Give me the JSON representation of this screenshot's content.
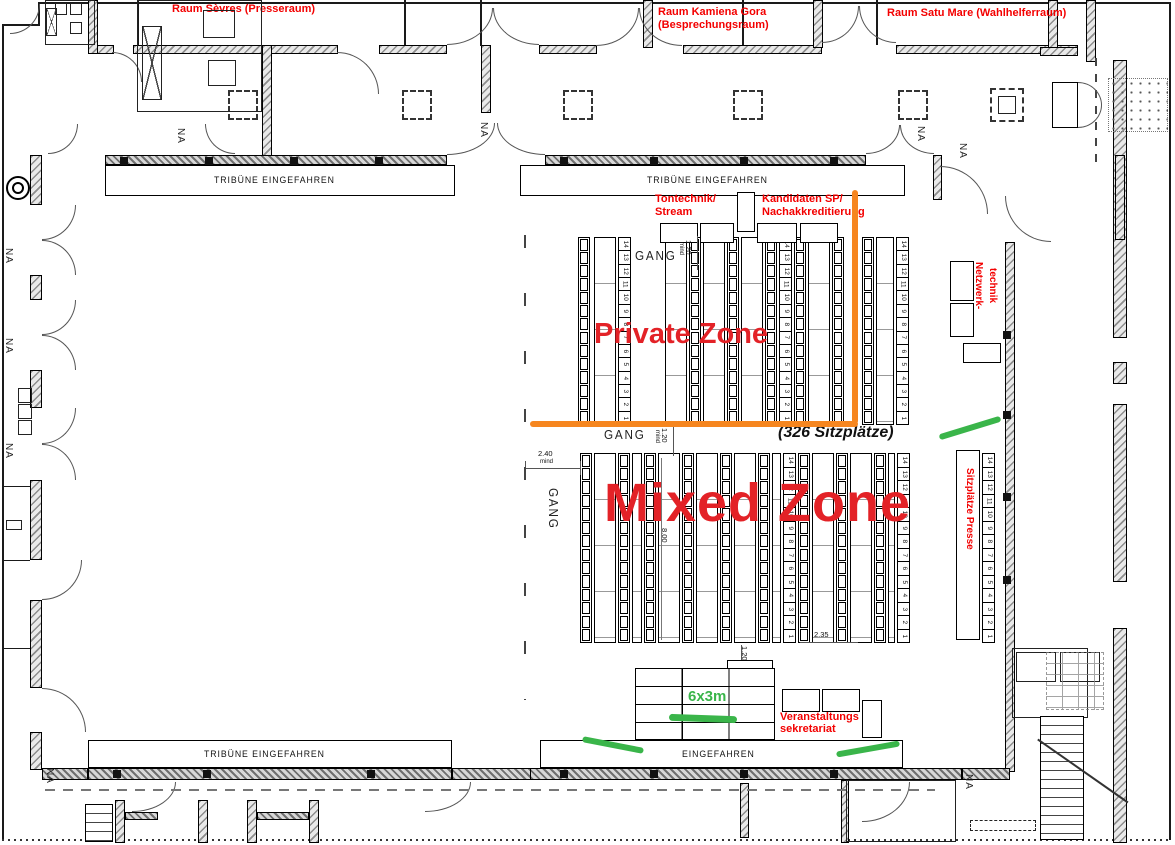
{
  "palette": {
    "label_red": "#f30000",
    "zone_red": "#e32227",
    "orange": "#f6861f",
    "green": "#3ab54a"
  },
  "rooms": {
    "sevres": "Raum Sèvres (Presseraum)",
    "kamiena_1": "Raum Kamiena Gora",
    "kamiena_2": "(Besprechungsraum)",
    "satu_mare": "Raum Satu Mare (Wahlhelferraum)"
  },
  "zones": {
    "private": "Private Zone",
    "mixed": "Mixed Zone",
    "seat_count": "(326 Sitzplätze)"
  },
  "areas": {
    "tontechnik_1": "Tontechnik/",
    "tontechnik_2": "Stream",
    "kandidaten_1": "Kandidaten SP/",
    "kandidaten_2": "Nachakkreditierung",
    "netzwerk_1": "Netzwerk-",
    "netzwerk_2": "technik",
    "presse": "Sitzplätze Presse",
    "veranstaltung_1": "Veranstaltungs",
    "veranstaltung_2": "sekretariat",
    "stage_size": "6x3m"
  },
  "plan": {
    "tribune": "TRIBÜNE EINGEFAHREN",
    "eingefahren": "EINGEFAHREN",
    "gang": "GANG",
    "na": "NA"
  },
  "dimensions": {
    "d240": "2.40",
    "d120": "1.20",
    "d800": "8.00",
    "d235": "2.35",
    "mind": "mind"
  },
  "seats": {
    "numbers": [
      "14",
      "13",
      "12",
      "11",
      "10",
      "9",
      "8",
      "7",
      "6",
      "5",
      "4",
      "3",
      "2",
      "1"
    ]
  }
}
